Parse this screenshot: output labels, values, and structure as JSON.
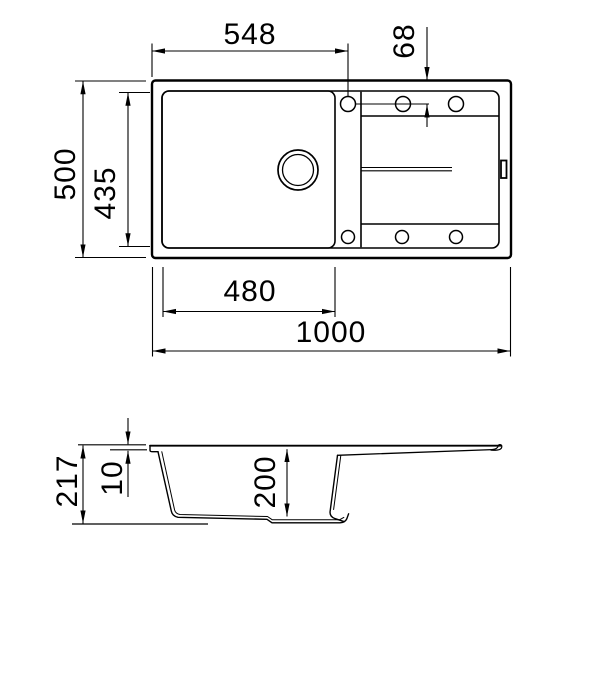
{
  "drawing": {
    "type": "sink-dimension-drawing",
    "line_color": "#000000",
    "background_color": "#ffffff",
    "views": {
      "top_view": "plan view of sink with bowl, tap ledge holes and drainer",
      "side_view": "cross-section profile of sink"
    },
    "dimensions_mm": {
      "top": {
        "tap_from_left": "548",
        "tap_from_top": "68",
        "overall_width": "500",
        "inner_width": "435",
        "bowl_length": "480",
        "overall_length": "1000"
      },
      "side": {
        "overall_height": "217",
        "rim_height": "10",
        "bowl_depth": "200"
      }
    }
  }
}
